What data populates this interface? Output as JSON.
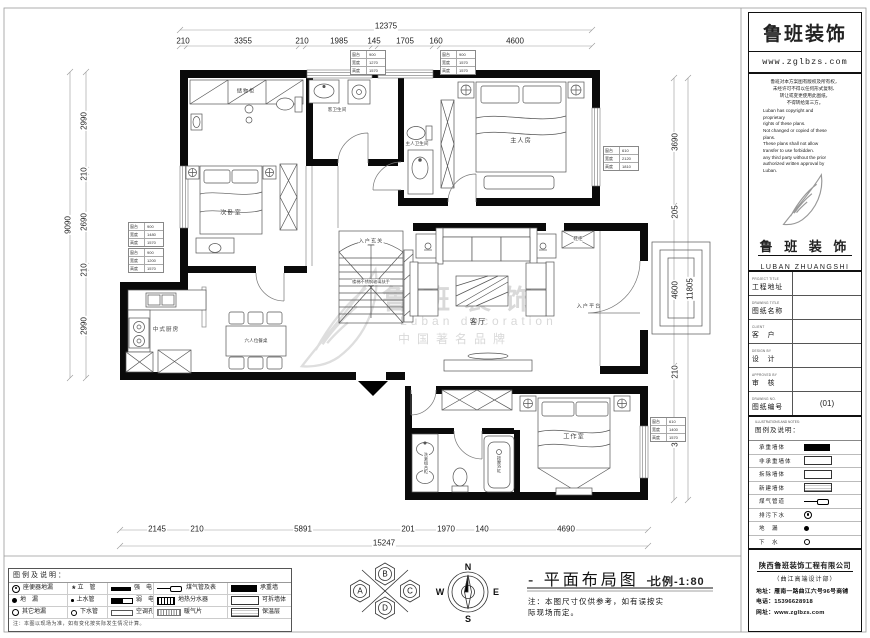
{
  "sheet": {
    "drawing_title": "- 平面布局图 -",
    "scale_label": "比例-1:80",
    "note": [
      "注：本图尺寸仅供参考，如有误按实",
      "际现场而定。"
    ],
    "compass": {
      "n": "N",
      "e": "E",
      "s": "S",
      "w": "W"
    },
    "rosette": {
      "a": "A",
      "b": "B",
      "c": "C",
      "d": "D"
    },
    "watermark": {
      "brand": "鲁班装饰",
      "en": "Luban decoration",
      "cn": "中国著名品牌"
    }
  },
  "rooms": {
    "storage": "储物柜",
    "guest_bath": "客卫生间",
    "master_bath": "主人卫生间",
    "master_bedroom": "主人房",
    "second_bedroom": "次卧室",
    "foyer": "入户玄关",
    "stair_note": "楼梯不锈钢玻璃扶手",
    "living": "客厅",
    "entry_platform": "入户平台",
    "shoe_cabinet": "鞋柜",
    "kitchen": "中式厨房",
    "dining": "六人位餐桌",
    "studio": "工作室",
    "bathtub": "按摩浴缸",
    "vanity": "洗漱组合柜"
  },
  "dims": {
    "top": {
      "total": "12375",
      "segments": [
        "210",
        "3355",
        "210",
        "1985",
        "145",
        "1705",
        "160",
        "4600"
      ]
    },
    "bottom": {
      "total": "15247",
      "segments": [
        "2145",
        "210",
        "5891",
        "201",
        "1970",
        "140",
        "4690"
      ]
    },
    "left": {
      "total": "9090",
      "segments": [
        "2990",
        "210",
        "2690",
        "210",
        "2990"
      ]
    },
    "right": {
      "total": "11805",
      "segments": [
        "3690",
        "205",
        "4600",
        "210",
        "3100"
      ]
    }
  },
  "window_tables": [
    {
      "rows": [
        [
          "窗台",
          "900"
        ],
        [
          "宽度",
          "1270"
        ],
        [
          "高度",
          "1570"
        ]
      ]
    },
    {
      "rows": [
        [
          "窗台",
          "900"
        ],
        [
          "宽度",
          "1570"
        ],
        [
          "高度",
          "1570"
        ]
      ]
    },
    {
      "rows": [
        [
          "窗台",
          "610"
        ],
        [
          "宽度",
          "2120"
        ],
        [
          "高度",
          "1810"
        ]
      ]
    },
    {
      "rows": [
        [
          "窗台",
          "900"
        ],
        [
          "宽度",
          "1480"
        ],
        [
          "高度",
          "1570"
        ]
      ]
    },
    {
      "rows": [
        [
          "窗台",
          "900"
        ],
        [
          "宽度",
          "1200"
        ],
        [
          "高度",
          "1570"
        ]
      ]
    },
    {
      "rows": [
        [
          "窗台",
          "610"
        ],
        [
          "宽度",
          "1400"
        ],
        [
          "高度",
          "1570"
        ]
      ]
    }
  ],
  "legend": {
    "header": "图例及说明：",
    "cells": [
      [
        {
          "sym": "drain-ring-dot",
          "label": "座便器地漏"
        },
        {
          "sym": "star-pipe",
          "label": "立　管"
        },
        {
          "sym": "bar-solid",
          "label": "强　电"
        },
        {
          "sym": "gas-pipe-meter",
          "label": "煤气管及表"
        },
        {
          "sym": "wall-solid",
          "label": "承重墙"
        }
      ],
      [
        {
          "sym": "drain-dot",
          "label": "地　漏"
        },
        {
          "sym": "dot-small",
          "label": "上水管"
        },
        {
          "sym": "bar-weak",
          "label": "弱　电"
        },
        {
          "sym": "manifold",
          "label": "地热分水器"
        },
        {
          "sym": "wall-outline",
          "label": "可拆墙体"
        }
      ],
      [
        {
          "sym": "drain-other",
          "label": "其它地漏"
        },
        {
          "sym": "ring-small",
          "label": "下水管"
        },
        {
          "sym": "bar-outline",
          "label": "空调孔"
        },
        {
          "sym": "radiator",
          "label": "暖气片"
        },
        {
          "sym": "wall-hatch",
          "label": "保温层"
        }
      ]
    ],
    "note": "注：本图以现场为准，如有变化按实际发生情况计算。"
  },
  "panel": {
    "brand": "鲁班装饰",
    "website": "www.zglbzs.com",
    "copyright_cn": [
      "鲁班对本方案图有版权及所有权，",
      "未经许可不得以任何形式复制、",
      "转让或变更使用此图纸，",
      "不得转给第三方。"
    ],
    "copyright_en": [
      "Luban has copyright and",
      "proprietary",
      "rights of these plans.",
      "Not changed or copied of these",
      "plans.",
      "These plans shall not allow",
      "transfer to use forbidden.",
      "any third party without the prior",
      "authorized written approval by",
      "Luban."
    ],
    "logo_cn": "鲁 班 装 饰",
    "logo_en": "LUBAN ZHUANGSHI",
    "fields": [
      {
        "en": "PROJECT TITLE",
        "cn": "工程地址",
        "value": ""
      },
      {
        "en": "DRAWING TITLE",
        "cn": "图纸名称",
        "value": ""
      },
      {
        "en": "CLIENT",
        "cn": "客　户",
        "value": ""
      },
      {
        "en": "DESIGN BY",
        "cn": "设　计",
        "value": ""
      },
      {
        "en": "APPROVED BY",
        "cn": "审　核",
        "value": ""
      },
      {
        "en": "DRAWING NO.",
        "cn": "图纸编号",
        "value": "(01)"
      }
    ],
    "legend_title_en": "ILLUSTRATIONS AND NOTES:",
    "legend_title_cn": "图例及说明：",
    "legend_rows": [
      {
        "label": "承重墙体",
        "sym": "wall-solid"
      },
      {
        "label": "非承重墙体",
        "sym": "wall-outline"
      },
      {
        "label": "拆除墙体",
        "sym": "wall-outline"
      },
      {
        "label": "新建墙体",
        "sym": "wall-hatch"
      },
      {
        "label": "煤气管道",
        "sym": "gas-pipe"
      },
      {
        "label": "排污下水",
        "sym": "drain-ring"
      },
      {
        "label": "地　漏",
        "sym": "drain-dot"
      },
      {
        "label": "下　水",
        "sym": "ring-small"
      }
    ],
    "company": "陕西鲁班装饰工程有限公司",
    "department": "（曲江高端设计部）",
    "address": "地址：雁南一路曲江六号96号商铺",
    "phone": "电话：15396628918",
    "web": "网址：www.zglbzs.com"
  }
}
